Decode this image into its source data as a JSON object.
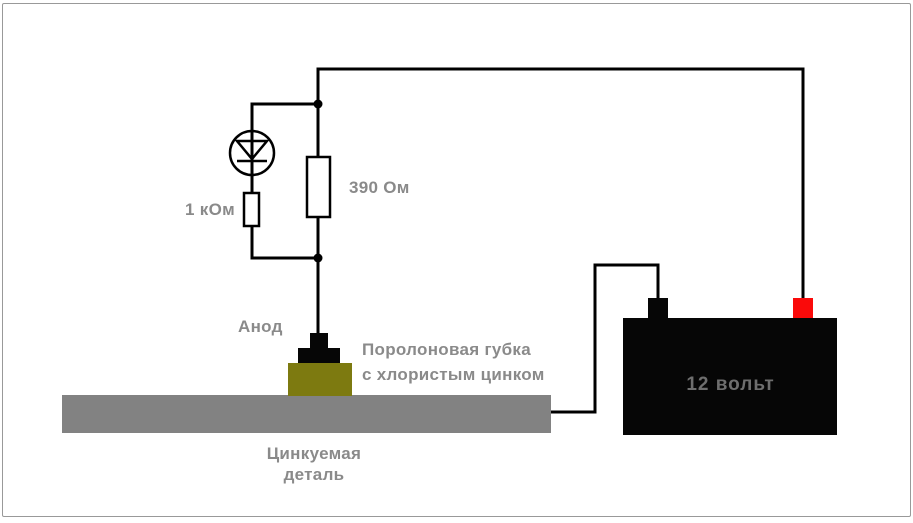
{
  "schematic": {
    "labels": {
      "series_resistor": "1 кОм",
      "parallel_resistor": "390 Ом",
      "anode": "Анод",
      "sponge_line1": "Поролоновая губка",
      "sponge_line2": "с хлористым цинком",
      "part_line1": "Цинкуемая",
      "part_line2": "деталь",
      "battery_voltage": "12 вольт"
    },
    "colors": {
      "wire": "#000000",
      "component_fill": "#ffffff",
      "label_text": "#8a8a8a",
      "battery_body": "#060606",
      "battery_label": "#6e6e6e",
      "terminal_positive": "#fa0a0a",
      "terminal_negative": "#060606",
      "anode_contact": "#060606",
      "sponge": "#7d7a10",
      "workpiece": "#828282",
      "frame": "#999999",
      "background": "#ffffff"
    }
  }
}
